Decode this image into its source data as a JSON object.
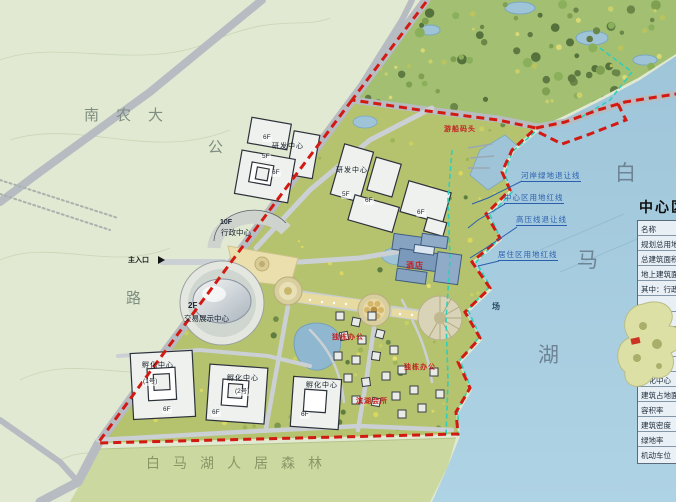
{
  "map": {
    "area_labels": {
      "nanongda": "南农大",
      "road_char_gong": "公",
      "road_char_lu": "路",
      "forest_belt": "白马湖人居森林",
      "lake_char_bai": "白",
      "lake_char_ma": "马",
      "lake_char_hu": "湖",
      "main_entrance": "主入口",
      "plaza_char": "场"
    },
    "buildings": {
      "exhibition_floor": "2F",
      "exhibition_name": "交易展示中心",
      "admin_floor": "10F",
      "admin_name": "行政中心",
      "rd_center_a": "研发中心",
      "rd_center_b": "研发中心",
      "incubator_a": "孵化中心",
      "incubator_a_no": "(1号)",
      "incubator_b": "孵化中心",
      "incubator_b_no": "(2号)",
      "incubator_c": "孵化中心",
      "hotel": "酒店",
      "floor_6f": "6F",
      "floor_5f": "5F"
    },
    "red_labels": {
      "dock": "游船码头",
      "villa_a": "独栋办公",
      "villa_b": "独栋办公",
      "club": "滨湖会所"
    },
    "setback_labels": {
      "riverbank": "河岸绿地退让线",
      "center_redline": "中心区用地红线",
      "hv_line": "高压线退让线",
      "residential_redline": "居住区用地红线"
    }
  },
  "legend": {
    "title": "中心区",
    "rows": [
      "名称",
      "规划总用地",
      "总建筑面积",
      "地上建筑面积",
      "其中：行政中心",
      "",
      "",
      "",
      "",
      "",
      "孵化中心",
      "建筑占地面积",
      "容积率",
      "建筑密度",
      "绿地率",
      "机动车位"
    ]
  },
  "colors": {
    "boundary_red": "#d31a12",
    "setback_cyan": "#2ecfbb",
    "annotation_blue": "#2b5fae",
    "lake_blue": "#a4c9dd"
  }
}
